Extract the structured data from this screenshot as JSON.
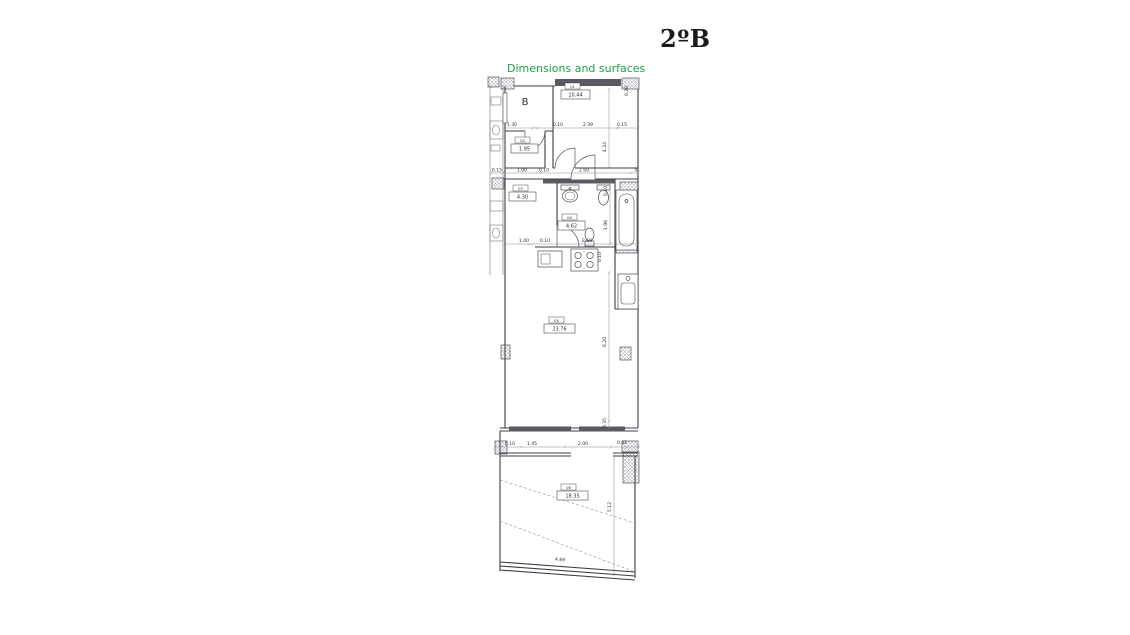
{
  "header": {
    "title": "2ºB",
    "subtitle": "Dimensions and surfaces"
  },
  "plan": {
    "block_label": "B",
    "rooms": [
      {
        "code": "01",
        "area": "10.44"
      },
      {
        "code": "02",
        "area": "1.95"
      },
      {
        "code": "03",
        "area": "4.30"
      },
      {
        "code": "04",
        "area": "4.62"
      },
      {
        "code": "05",
        "area": "23.76"
      },
      {
        "code": "06",
        "area": "18.35"
      }
    ],
    "dims": {
      "row1": [
        "1.30",
        "0.10",
        "2.39",
        "0.15"
      ],
      "row2": [
        "0.15",
        "1.00",
        "0.10",
        "2.69",
        "0"
      ],
      "row3": [
        "1.00",
        "0.10",
        "2.69"
      ],
      "row4": [
        "0.10",
        "1.45",
        "2.00",
        "0.32"
      ],
      "col_right": [
        "0.26",
        "4.24",
        "0.10",
        "1.96",
        "0.10",
        "6.20",
        "0.35",
        "5.12"
      ],
      "terrace_bottom": "4.69"
    }
  },
  "colors": {
    "subtitle_green": "#1ca24b",
    "line": "#4b4b55",
    "wall_dark": "#5a5a62"
  }
}
